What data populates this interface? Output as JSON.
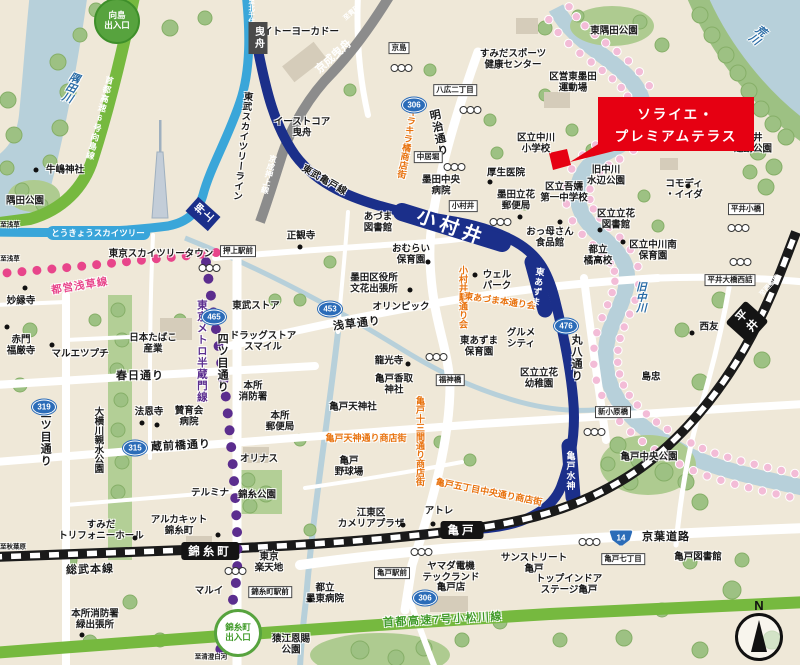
{
  "colors": {
    "background": "#efe8d8",
    "road_white": "#ffffff",
    "river": "#b7d0da",
    "park_green": "#9dc183",
    "expressway_green": "#76b93f",
    "tobu_kameido_navy": "#1b2f8a",
    "tobu_skytree_blue": "#3aa6d9",
    "keisei_gray": "#8c8c8c",
    "jr_black": "#1a1a1a",
    "hanzomon_purple": "#5b2d8e",
    "asakusa_pink": "#e8458b",
    "shopping_orange": "#e8720e",
    "property_red": "#e60012",
    "badge_blue": "#2b6cb8",
    "blossom_pink": "#f3bcd7"
  },
  "property": {
    "line1": "ソライエ・",
    "line2": "プレミアムテラス"
  },
  "compass": {
    "label": "N"
  },
  "entrances": [
    {
      "name": "mukojima-entrance",
      "lines": [
        "向島",
        "出入口"
      ],
      "x": 117,
      "y": 21,
      "variant": "solid"
    },
    {
      "name": "kinshicho-entrance",
      "lines": [
        "錦糸町",
        "出入口"
      ],
      "x": 238,
      "y": 633,
      "variant": "outline"
    }
  ],
  "stations": [
    {
      "name": "station-hikifune",
      "label": "曳舟",
      "x": 258,
      "y": 38,
      "kind": "st-box-dark",
      "vertical": true
    },
    {
      "name": "station-keisei-hikifune",
      "label": "京成曳舟",
      "x": 333,
      "y": 56,
      "kind": "st-online",
      "rotate": -42,
      "fs": 11
    },
    {
      "name": "station-oshiage",
      "label": "押上",
      "x": 203,
      "y": 214,
      "kind": "st-box-navy",
      "vertical": true,
      "rotate": -48
    },
    {
      "name": "station-tokyo-skytree",
      "label": "とうきょうスカイツリー",
      "x": 98,
      "y": 233,
      "kind": "st-box-sky"
    },
    {
      "name": "station-komurai",
      "label": "小村井",
      "x": 452,
      "y": 226,
      "kind": "st-online-big",
      "rotate": 20
    },
    {
      "name": "station-higashi-azuma",
      "label": "東あずま",
      "x": 538,
      "y": 287,
      "kind": "st-online-v",
      "vertical": true,
      "rotate": 8
    },
    {
      "name": "station-kameido-suijin",
      "label": "亀戸水神",
      "x": 571,
      "y": 471,
      "kind": "st-online-v",
      "vertical": true
    },
    {
      "name": "station-kameido",
      "label": "亀戸",
      "x": 462,
      "y": 530,
      "kind": "st-box-black"
    },
    {
      "name": "station-kinshicho",
      "label": "錦糸町",
      "x": 210,
      "y": 551,
      "kind": "st-box-black"
    },
    {
      "name": "station-hirai",
      "label": "平井",
      "x": 747,
      "y": 322,
      "kind": "st-box-black",
      "vertical": true,
      "rotate": -48
    }
  ],
  "crossings": [
    {
      "label": "京島",
      "x": 399,
      "y": 48
    },
    {
      "label": "八広二丁目",
      "x": 455,
      "y": 90
    },
    {
      "label": "中居堀",
      "x": 428,
      "y": 157
    },
    {
      "label": "押上駅前",
      "x": 238,
      "y": 251
    },
    {
      "label": "小村井",
      "x": 463,
      "y": 206
    },
    {
      "label": "福神橋",
      "x": 450,
      "y": 380
    },
    {
      "label": "新小原橋",
      "x": 613,
      "y": 412
    },
    {
      "label": "平井小橋",
      "x": 746,
      "y": 209
    },
    {
      "label": "平井大橋西詰",
      "x": 730,
      "y": 280
    },
    {
      "label": "亀戸七丁目",
      "x": 623,
      "y": 559
    },
    {
      "label": "亀戸駅前",
      "x": 392,
      "y": 573
    },
    {
      "label": "錦糸町駅前",
      "x": 270,
      "y": 592
    }
  ],
  "route_badges": [
    {
      "num": "306",
      "x": 414,
      "y": 105
    },
    {
      "num": "465",
      "x": 214,
      "y": 317
    },
    {
      "num": "453",
      "x": 330,
      "y": 309
    },
    {
      "num": "319",
      "x": 44,
      "y": 407
    },
    {
      "num": "315",
      "x": 135,
      "y": 448
    },
    {
      "num": "476",
      "x": 566,
      "y": 326
    },
    {
      "num": "14",
      "x": 621,
      "y": 538,
      "kokudo": true
    },
    {
      "num": "306",
      "x": 425,
      "y": 598
    }
  ],
  "signals": [
    {
      "x": 402,
      "y": 68
    },
    {
      "x": 471,
      "y": 110
    },
    {
      "x": 455,
      "y": 167
    },
    {
      "x": 210,
      "y": 268
    },
    {
      "x": 501,
      "y": 222
    },
    {
      "x": 437,
      "y": 357
    },
    {
      "x": 595,
      "y": 432
    },
    {
      "x": 590,
      "y": 542
    },
    {
      "x": 422,
      "y": 552
    },
    {
      "x": 236,
      "y": 571
    },
    {
      "x": 739,
      "y": 228
    },
    {
      "x": 741,
      "y": 262
    }
  ],
  "poi_dots": [
    {
      "x": 36,
      "y": 170
    },
    {
      "x": 25,
      "y": 288
    },
    {
      "x": 7,
      "y": 327
    },
    {
      "x": 52,
      "y": 345
    },
    {
      "x": 142,
      "y": 423
    },
    {
      "x": 300,
      "y": 247
    },
    {
      "x": 410,
      "y": 290
    },
    {
      "x": 428,
      "y": 262
    },
    {
      "x": 475,
      "y": 275
    },
    {
      "x": 490,
      "y": 182
    },
    {
      "x": 520,
      "y": 217
    },
    {
      "x": 560,
      "y": 222
    },
    {
      "x": 600,
      "y": 230
    },
    {
      "x": 623,
      "y": 242
    },
    {
      "x": 692,
      "y": 333
    },
    {
      "x": 688,
      "y": 186
    },
    {
      "x": 408,
      "y": 364
    },
    {
      "x": 403,
      "y": 525
    },
    {
      "x": 433,
      "y": 524
    },
    {
      "x": 135,
      "y": 538
    },
    {
      "x": 82,
      "y": 635
    },
    {
      "x": 218,
      "y": 535
    },
    {
      "x": 157,
      "y": 425
    },
    {
      "x": 310,
      "y": 600
    }
  ],
  "labels": [
    {
      "t": "イトーヨーカドー",
      "x": 301,
      "y": 33,
      "c": "place"
    },
    {
      "l": [
        "イーストコア",
        "曳舟"
      ],
      "x": 302,
      "y": 128,
      "c": "place"
    },
    {
      "t": "京成押上線",
      "x": 268,
      "y": 174,
      "c": "wline",
      "v": true,
      "r": 14
    },
    {
      "t": "東武スカイツリーライン",
      "x": 241,
      "y": 146,
      "c": "railname",
      "v": true,
      "r": 6
    },
    {
      "t": "東武亀戸線",
      "x": 324,
      "y": 181,
      "c": "railname",
      "r": 30
    },
    {
      "t": "至北千住",
      "x": 250,
      "y": 11,
      "c": "dir-w",
      "v": true
    },
    {
      "t": "至青砥",
      "x": 352,
      "y": 13,
      "c": "dir-w",
      "r": -42
    },
    {
      "t": "至浅草",
      "x": 10,
      "y": 225,
      "c": "dir"
    },
    {
      "t": "至浅草",
      "x": 10,
      "y": 259,
      "c": "dir"
    },
    {
      "t": "至秋葉原",
      "x": 13,
      "y": 547,
      "c": "dir"
    },
    {
      "t": "至清澄白河",
      "x": 211,
      "y": 657,
      "c": "dir"
    },
    {
      "t": "至西船橋",
      "x": 770,
      "y": 286,
      "c": "dir-w",
      "r": -47
    },
    {
      "t": "隅田川",
      "x": 70,
      "y": 87,
      "c": "river",
      "v": true,
      "r": 20
    },
    {
      "t": "荒川",
      "x": 757,
      "y": 34,
      "c": "river",
      "v": true,
      "r": 38
    },
    {
      "t": "旧中川",
      "x": 640,
      "y": 297,
      "c": "river",
      "v": true
    },
    {
      "t": "首都高速6号向島線",
      "x": 99,
      "y": 118,
      "c": "hw",
      "v": true,
      "r": 14
    },
    {
      "t": "首都高速7号小松川線",
      "x": 443,
      "y": 620,
      "c": "hw-green",
      "r": -3
    },
    {
      "t": "都営浅草線",
      "x": 80,
      "y": 287,
      "c": "toei",
      "r": -9
    },
    {
      "t": "東京メトロ半蔵門線",
      "x": 201,
      "y": 351,
      "c": "metro",
      "v": true
    },
    {
      "t": "四ツ目通り",
      "x": 222,
      "y": 363,
      "c": "road",
      "v": true
    },
    {
      "t": "三ツ目通り",
      "x": 45,
      "y": 437,
      "c": "road",
      "v": true
    },
    {
      "t": "明治通り",
      "x": 438,
      "y": 133,
      "c": "road",
      "v": true,
      "r": -12
    },
    {
      "t": "浅草通り",
      "x": 357,
      "y": 324,
      "c": "road",
      "r": -7
    },
    {
      "t": "春日通り",
      "x": 140,
      "y": 376,
      "c": "road"
    },
    {
      "t": "蔵前橋通り",
      "x": 181,
      "y": 446,
      "c": "road",
      "r": -3
    },
    {
      "t": "京葉道路",
      "x": 666,
      "y": 537,
      "c": "road"
    },
    {
      "t": "丸八通り",
      "x": 576,
      "y": 358,
      "c": "road",
      "v": true
    },
    {
      "t": "総武本線",
      "x": 90,
      "y": 570,
      "c": "road",
      "r": -2
    },
    {
      "t": "大横川親水公園",
      "x": 97,
      "y": 440,
      "c": "place",
      "v": true
    },
    {
      "t": "東京スカイツリータウン",
      "x": 161,
      "y": 255,
      "c": "place"
    },
    {
      "t": "キラキラ橘商店街",
      "x": 407,
      "y": 143,
      "c": "shopping",
      "v": true,
      "r": 10
    },
    {
      "t": "小村井駅通り会",
      "x": 463,
      "y": 297,
      "c": "shopping",
      "v": true
    },
    {
      "t": "東あづま本通り会",
      "x": 500,
      "y": 301,
      "c": "shopping",
      "r": 8
    },
    {
      "t": "亀戸天神通り商店街",
      "x": 366,
      "y": 438,
      "c": "shopping"
    },
    {
      "t": "亀戸十三間通り商店街",
      "x": 420,
      "y": 441,
      "c": "shopping",
      "v": true
    },
    {
      "t": "亀戸五丁目中央通り商店街",
      "x": 489,
      "y": 492,
      "c": "shopping",
      "r": 11
    },
    {
      "t": "東隅田公園",
      "x": 614,
      "y": 32,
      "c": "place"
    },
    {
      "l": [
        "すみだスポーツ",
        "健康センター"
      ],
      "x": 513,
      "y": 60,
      "c": "place"
    },
    {
      "l": [
        "区営東墨田",
        "運動場"
      ],
      "x": 573,
      "y": 83,
      "c": "place"
    },
    {
      "l": [
        "区立中川",
        "小学校"
      ],
      "x": 536,
      "y": 144,
      "c": "place"
    },
    {
      "t": "厚生医院",
      "x": 506,
      "y": 174,
      "c": "place"
    },
    {
      "l": [
        "墨田中央",
        "病院"
      ],
      "x": 441,
      "y": 186,
      "c": "place"
    },
    {
      "l": [
        "墨田立花",
        "郵便局"
      ],
      "x": 516,
      "y": 201,
      "c": "place"
    },
    {
      "l": [
        "区立吾嬬",
        "第一中学校"
      ],
      "x": 564,
      "y": 193,
      "c": "place"
    },
    {
      "l": [
        "旧中川",
        "水辺公園"
      ],
      "x": 606,
      "y": 176,
      "c": "place"
    },
    {
      "l": [
        "コモディ",
        "・イイダ"
      ],
      "x": 684,
      "y": 190,
      "c": "place"
    },
    {
      "l": [
        "平井",
        "運動公園"
      ],
      "x": 753,
      "y": 144,
      "c": "place"
    },
    {
      "t": "牛嶋神社",
      "x": 65,
      "y": 171,
      "c": "place"
    },
    {
      "t": "隅田公園",
      "x": 25,
      "y": 202,
      "c": "place"
    },
    {
      "t": "正観寺",
      "x": 301,
      "y": 237,
      "c": "place"
    },
    {
      "l": [
        "あづま",
        "図書館"
      ],
      "x": 378,
      "y": 223,
      "c": "place"
    },
    {
      "l": [
        "おむらい",
        "保育園"
      ],
      "x": 411,
      "y": 255,
      "c": "place"
    },
    {
      "l": [
        "墨田区役所",
        "文花出張所"
      ],
      "x": 374,
      "y": 284,
      "c": "place"
    },
    {
      "t": "オリンピック",
      "x": 401,
      "y": 308,
      "c": "place"
    },
    {
      "l": [
        "ウェル",
        "パーク"
      ],
      "x": 497,
      "y": 281,
      "c": "place"
    },
    {
      "l": [
        "おっ母さん",
        "食品館"
      ],
      "x": 550,
      "y": 238,
      "c": "place"
    },
    {
      "l": [
        "都立",
        "橘高校"
      ],
      "x": 598,
      "y": 256,
      "c": "place"
    },
    {
      "l": [
        "区立立花",
        "図書館"
      ],
      "x": 616,
      "y": 220,
      "c": "place"
    },
    {
      "l": [
        "区立中川南",
        "保育園"
      ],
      "x": 653,
      "y": 251,
      "c": "place"
    },
    {
      "t": "西友",
      "x": 709,
      "y": 328,
      "c": "place"
    },
    {
      "t": "島忠",
      "x": 651,
      "y": 378,
      "c": "place"
    },
    {
      "t": "亀戸中央公園",
      "x": 649,
      "y": 458,
      "c": "place"
    },
    {
      "t": "亀戸図書館",
      "x": 698,
      "y": 558,
      "c": "place"
    },
    {
      "l": [
        "サンストリート",
        "亀戸"
      ],
      "x": 534,
      "y": 564,
      "c": "place"
    },
    {
      "l": [
        "トップインドア",
        "ステージ亀戸"
      ],
      "x": 569,
      "y": 585,
      "c": "place"
    },
    {
      "l": [
        "ヤマダ電機",
        "テックランド",
        "亀戸店"
      ],
      "x": 451,
      "y": 578,
      "c": "place"
    },
    {
      "l": [
        "江東区",
        "カメリアプラザ"
      ],
      "x": 371,
      "y": 519,
      "c": "place"
    },
    {
      "t": "アトレ",
      "x": 439,
      "y": 512,
      "c": "place"
    },
    {
      "l": [
        "亀戸",
        "野球場"
      ],
      "x": 349,
      "y": 467,
      "c": "place"
    },
    {
      "t": "亀戸天神社",
      "x": 353,
      "y": 408,
      "c": "place"
    },
    {
      "l": [
        "亀戸香取",
        "神社"
      ],
      "x": 394,
      "y": 385,
      "c": "place"
    },
    {
      "t": "龍光寺",
      "x": 389,
      "y": 362,
      "c": "place"
    },
    {
      "l": [
        "東あずま",
        "保育園"
      ],
      "x": 479,
      "y": 347,
      "c": "place"
    },
    {
      "l": [
        "グルメ",
        "シティ"
      ],
      "x": 521,
      "y": 339,
      "c": "place"
    },
    {
      "l": [
        "区立立花",
        "幼稚園"
      ],
      "x": 539,
      "y": 379,
      "c": "place"
    },
    {
      "t": "妙縁寺",
      "x": 21,
      "y": 302,
      "c": "place"
    },
    {
      "l": [
        "赤門",
        "福厳寺"
      ],
      "x": 21,
      "y": 346,
      "c": "place"
    },
    {
      "t": "マルエツプチ",
      "x": 80,
      "y": 355,
      "c": "place"
    },
    {
      "l": [
        "日本たばこ",
        "産業"
      ],
      "x": 153,
      "y": 344,
      "c": "place"
    },
    {
      "t": "法恩寺",
      "x": 149,
      "y": 413,
      "c": "place"
    },
    {
      "l": [
        "賛育会",
        "病院"
      ],
      "x": 189,
      "y": 417,
      "c": "place"
    },
    {
      "l": [
        "本所",
        "消防署"
      ],
      "x": 253,
      "y": 392,
      "c": "place"
    },
    {
      "l": [
        "本所",
        "郵便局"
      ],
      "x": 280,
      "y": 422,
      "c": "place"
    },
    {
      "t": "東武ストア",
      "x": 256,
      "y": 307,
      "c": "place"
    },
    {
      "l": [
        "ドラッグストア",
        "スマイル"
      ],
      "x": 263,
      "y": 342,
      "c": "place"
    },
    {
      "t": "オリナス",
      "x": 259,
      "y": 460,
      "c": "place"
    },
    {
      "t": "錦糸公園",
      "x": 257,
      "y": 496,
      "c": "place"
    },
    {
      "t": "テルミナ",
      "x": 210,
      "y": 494,
      "c": "place"
    },
    {
      "l": [
        "アルカキット",
        "錦糸町"
      ],
      "x": 179,
      "y": 526,
      "c": "place"
    },
    {
      "l": [
        "すみだ",
        "トリフォニーホール"
      ],
      "x": 101,
      "y": 531,
      "c": "place"
    },
    {
      "t": "マルイ",
      "x": 209,
      "y": 592,
      "c": "place"
    },
    {
      "l": [
        "東京",
        "楽天地"
      ],
      "x": 269,
      "y": 563,
      "c": "place"
    },
    {
      "l": [
        "都立",
        "墨東病院"
      ],
      "x": 325,
      "y": 594,
      "c": "place"
    },
    {
      "l": [
        "本所消防署",
        "緑出張所"
      ],
      "x": 95,
      "y": 620,
      "c": "place"
    },
    {
      "l": [
        "猿江恩賜",
        "公園"
      ],
      "x": 291,
      "y": 645,
      "c": "place"
    }
  ]
}
